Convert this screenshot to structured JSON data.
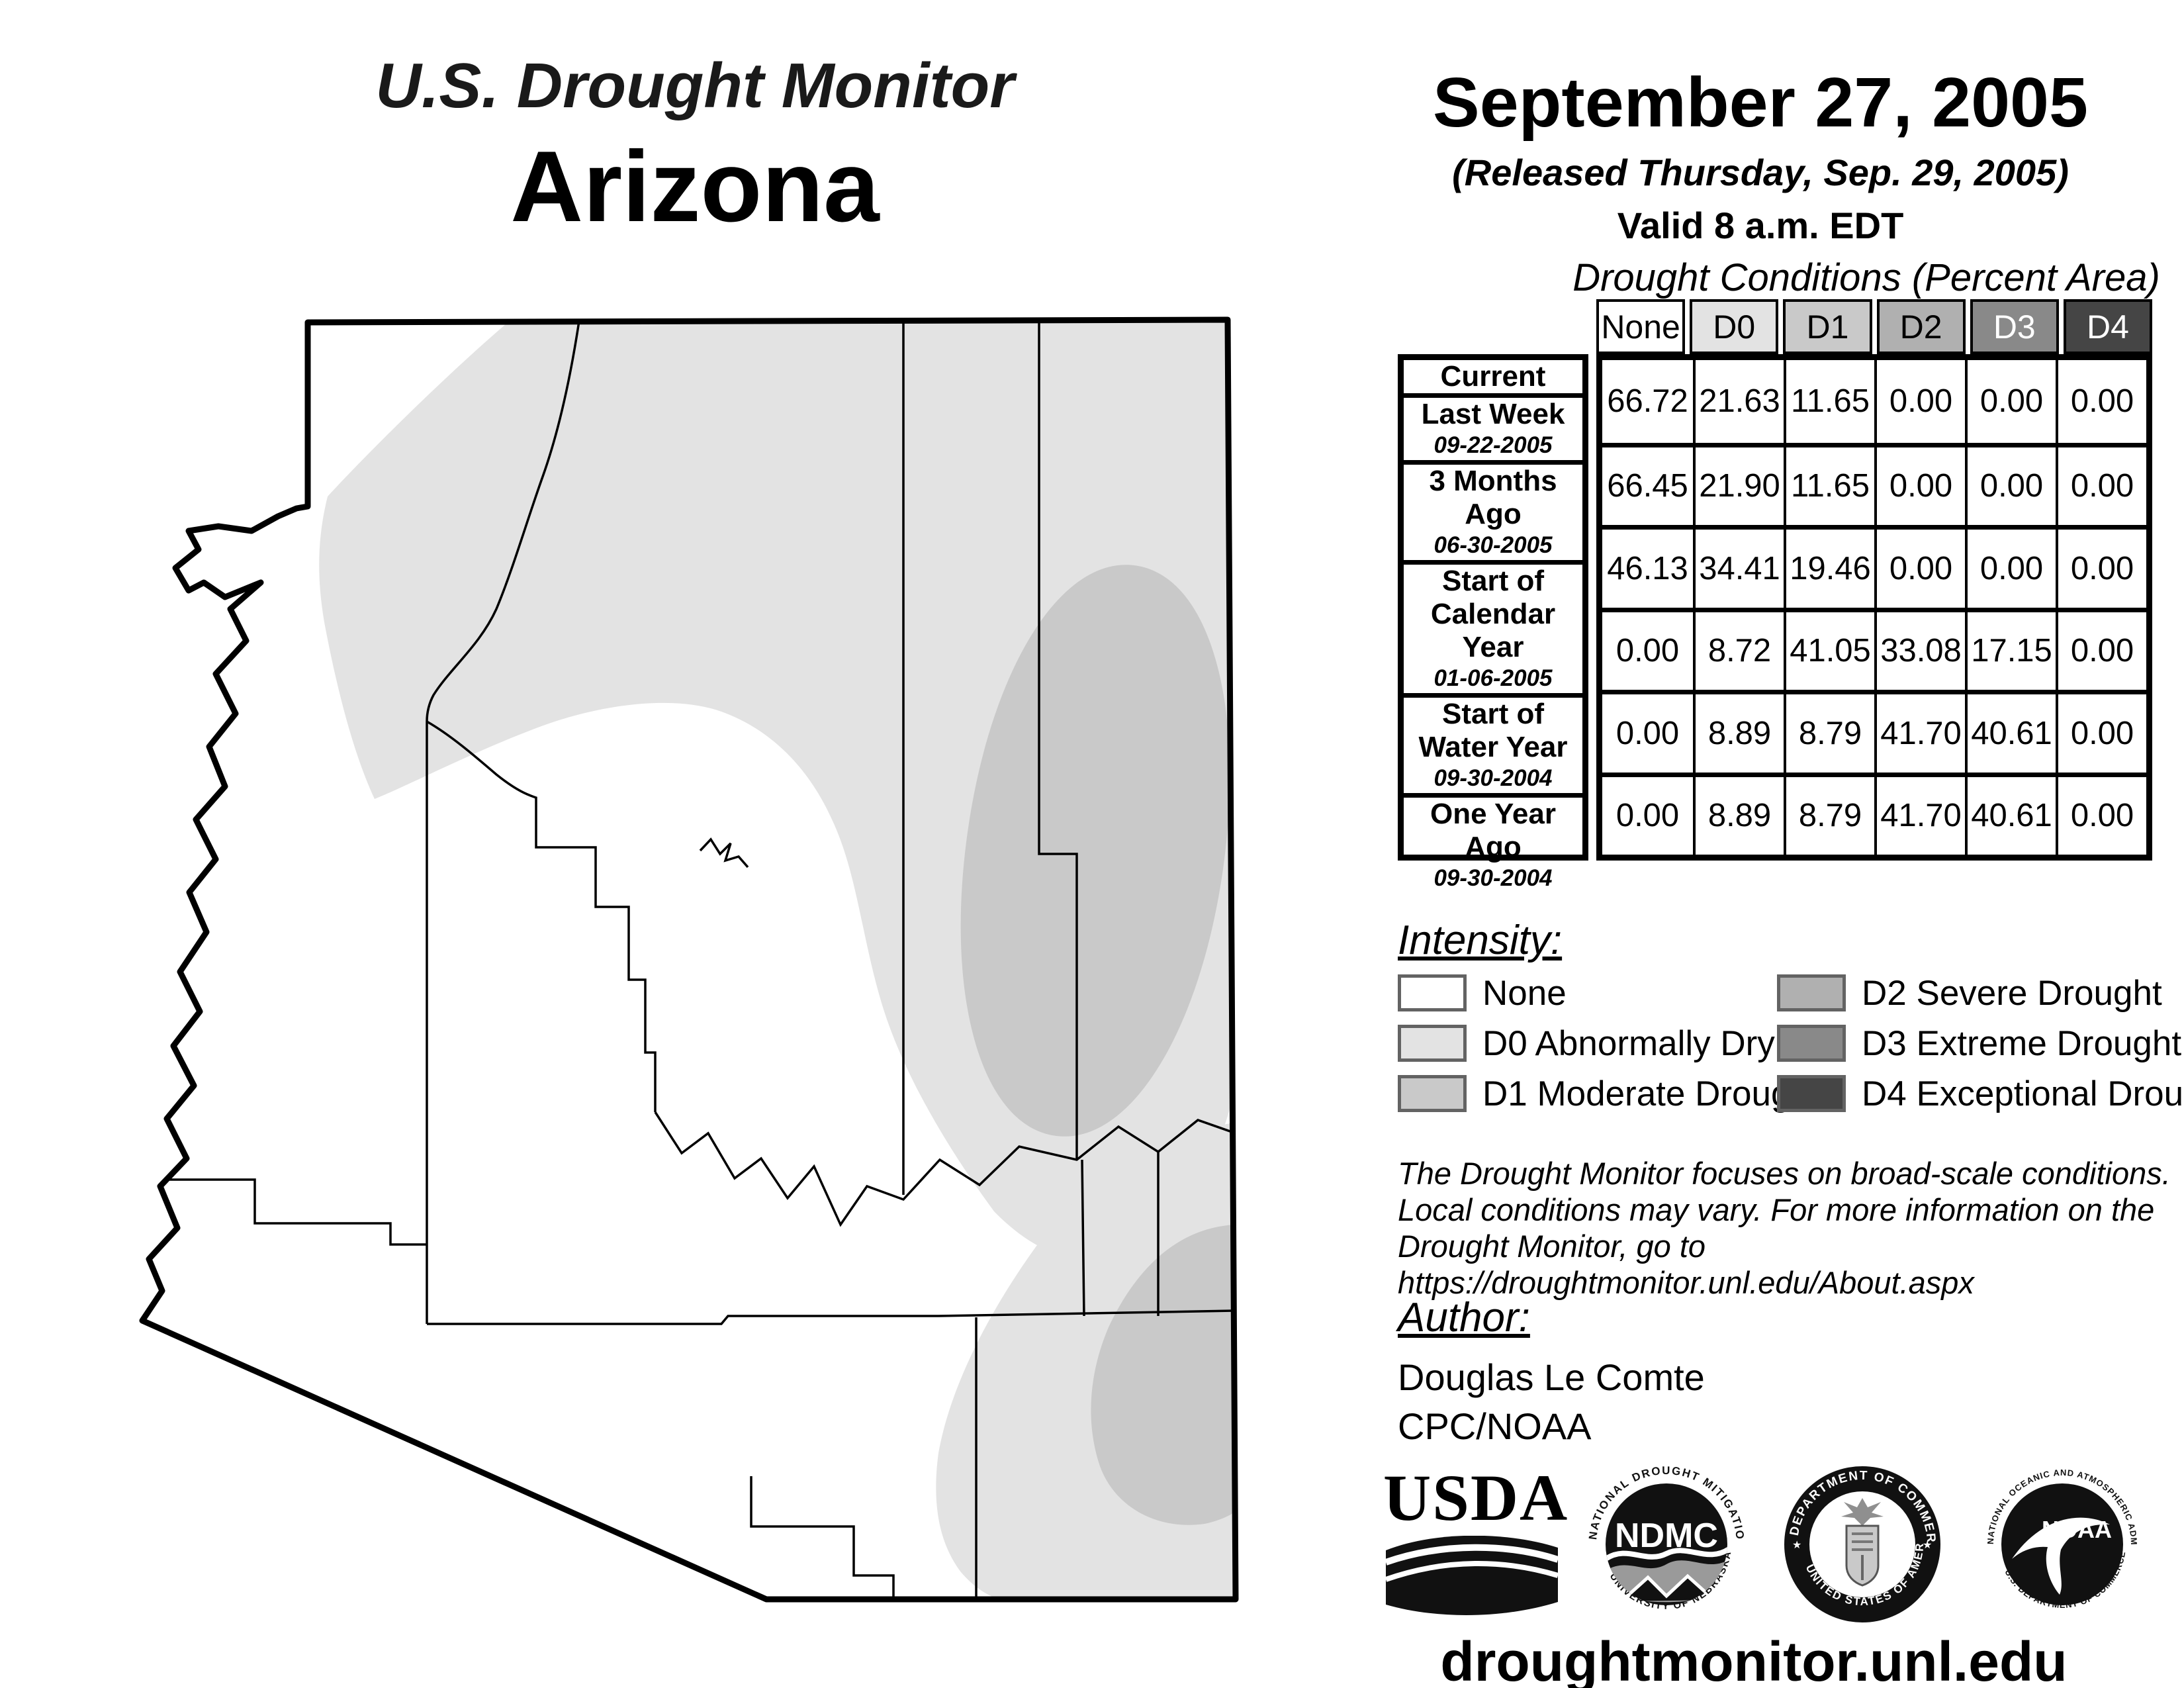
{
  "title": {
    "program": "U.S. Drought Monitor",
    "region": "Arizona"
  },
  "release": {
    "date": "September 27, 2005",
    "released": "(Released Thursday, Sep. 29, 2005)",
    "valid": "Valid 8 a.m. EDT"
  },
  "table": {
    "caption": "Drought Conditions (Percent Area)",
    "columns": [
      "None",
      "D0",
      "D1",
      "D2",
      "D3",
      "D4"
    ],
    "header_colors": [
      "#ffffff",
      "#e3e3e3",
      "#c9c9c9",
      "#b0b0b0",
      "#898989",
      "#454545"
    ],
    "rows": [
      {
        "label": "Current",
        "date": "",
        "values": [
          "66.72",
          "21.63",
          "11.65",
          "0.00",
          "0.00",
          "0.00"
        ]
      },
      {
        "label": "Last Week",
        "date": "09-22-2005",
        "values": [
          "66.45",
          "21.90",
          "11.65",
          "0.00",
          "0.00",
          "0.00"
        ]
      },
      {
        "label": "3 Months Ago",
        "date": "06-30-2005",
        "values": [
          "46.13",
          "34.41",
          "19.46",
          "0.00",
          "0.00",
          "0.00"
        ]
      },
      {
        "label": "Start of Calendar Year",
        "date": "01-06-2005",
        "values": [
          "0.00",
          "8.72",
          "41.05",
          "33.08",
          "17.15",
          "0.00"
        ]
      },
      {
        "label": "Start of Water Year",
        "date": "09-30-2004",
        "values": [
          "0.00",
          "8.89",
          "8.79",
          "41.70",
          "40.61",
          "0.00"
        ]
      },
      {
        "label": "One Year Ago",
        "date": "09-30-2004",
        "values": [
          "0.00",
          "8.89",
          "8.79",
          "41.70",
          "40.61",
          "0.00"
        ]
      }
    ]
  },
  "legend": {
    "heading": "Intensity:",
    "items": [
      {
        "code": "none",
        "label": "None",
        "color": "#ffffff"
      },
      {
        "code": "d0",
        "label": "D0 Abnormally Dry",
        "color": "#e3e3e3"
      },
      {
        "code": "d1",
        "label": "D1 Moderate Drought",
        "color": "#c9c9c9"
      },
      {
        "code": "d2",
        "label": "D2 Severe Drought",
        "color": "#b0b0b0"
      },
      {
        "code": "d3",
        "label": "D3 Extreme Drought",
        "color": "#898989"
      },
      {
        "code": "d4",
        "label": "D4 Exceptional Drought",
        "color": "#454545"
      }
    ]
  },
  "disclaimer": {
    "lines": [
      "The Drought Monitor focuses on broad-scale conditions.",
      "Local conditions may vary. For more information on the",
      "Drought Monitor, go to https://droughtmonitor.unl.edu/About.aspx"
    ]
  },
  "author": {
    "heading": "Author:",
    "name": "Douglas Le Comte",
    "org": "CPC/NOAA"
  },
  "footer": {
    "url": "droughtmonitor.unl.edu"
  },
  "logos": {
    "usda": {
      "text": "USDA"
    },
    "ndmc": {
      "center": "NDMC",
      "arc_top": "NATIONAL DROUGHT MITIGATION CENTER",
      "arc_bottom": "UNIVERSITY OF NEBRASKA"
    },
    "commerce": {
      "arc_top": "DEPARTMENT OF COMMERCE",
      "arc_bottom": "UNITED STATES OF AMERICA",
      "star": "★"
    },
    "noaa": {
      "center": "NOAA",
      "arc_top": "NATIONAL OCEANIC AND ATMOSPHERIC ADMINISTRATION",
      "arc_bottom": "U.S. DEPARTMENT OF COMMERCE"
    }
  },
  "map": {
    "state": "Arizona",
    "levels_present": [
      "None",
      "D0",
      "D1"
    ],
    "none_fill": "#ffffff",
    "d0_fill": "#e3e3e3",
    "d1_fill": "#c9c9c9",
    "border_color": "#000000"
  }
}
